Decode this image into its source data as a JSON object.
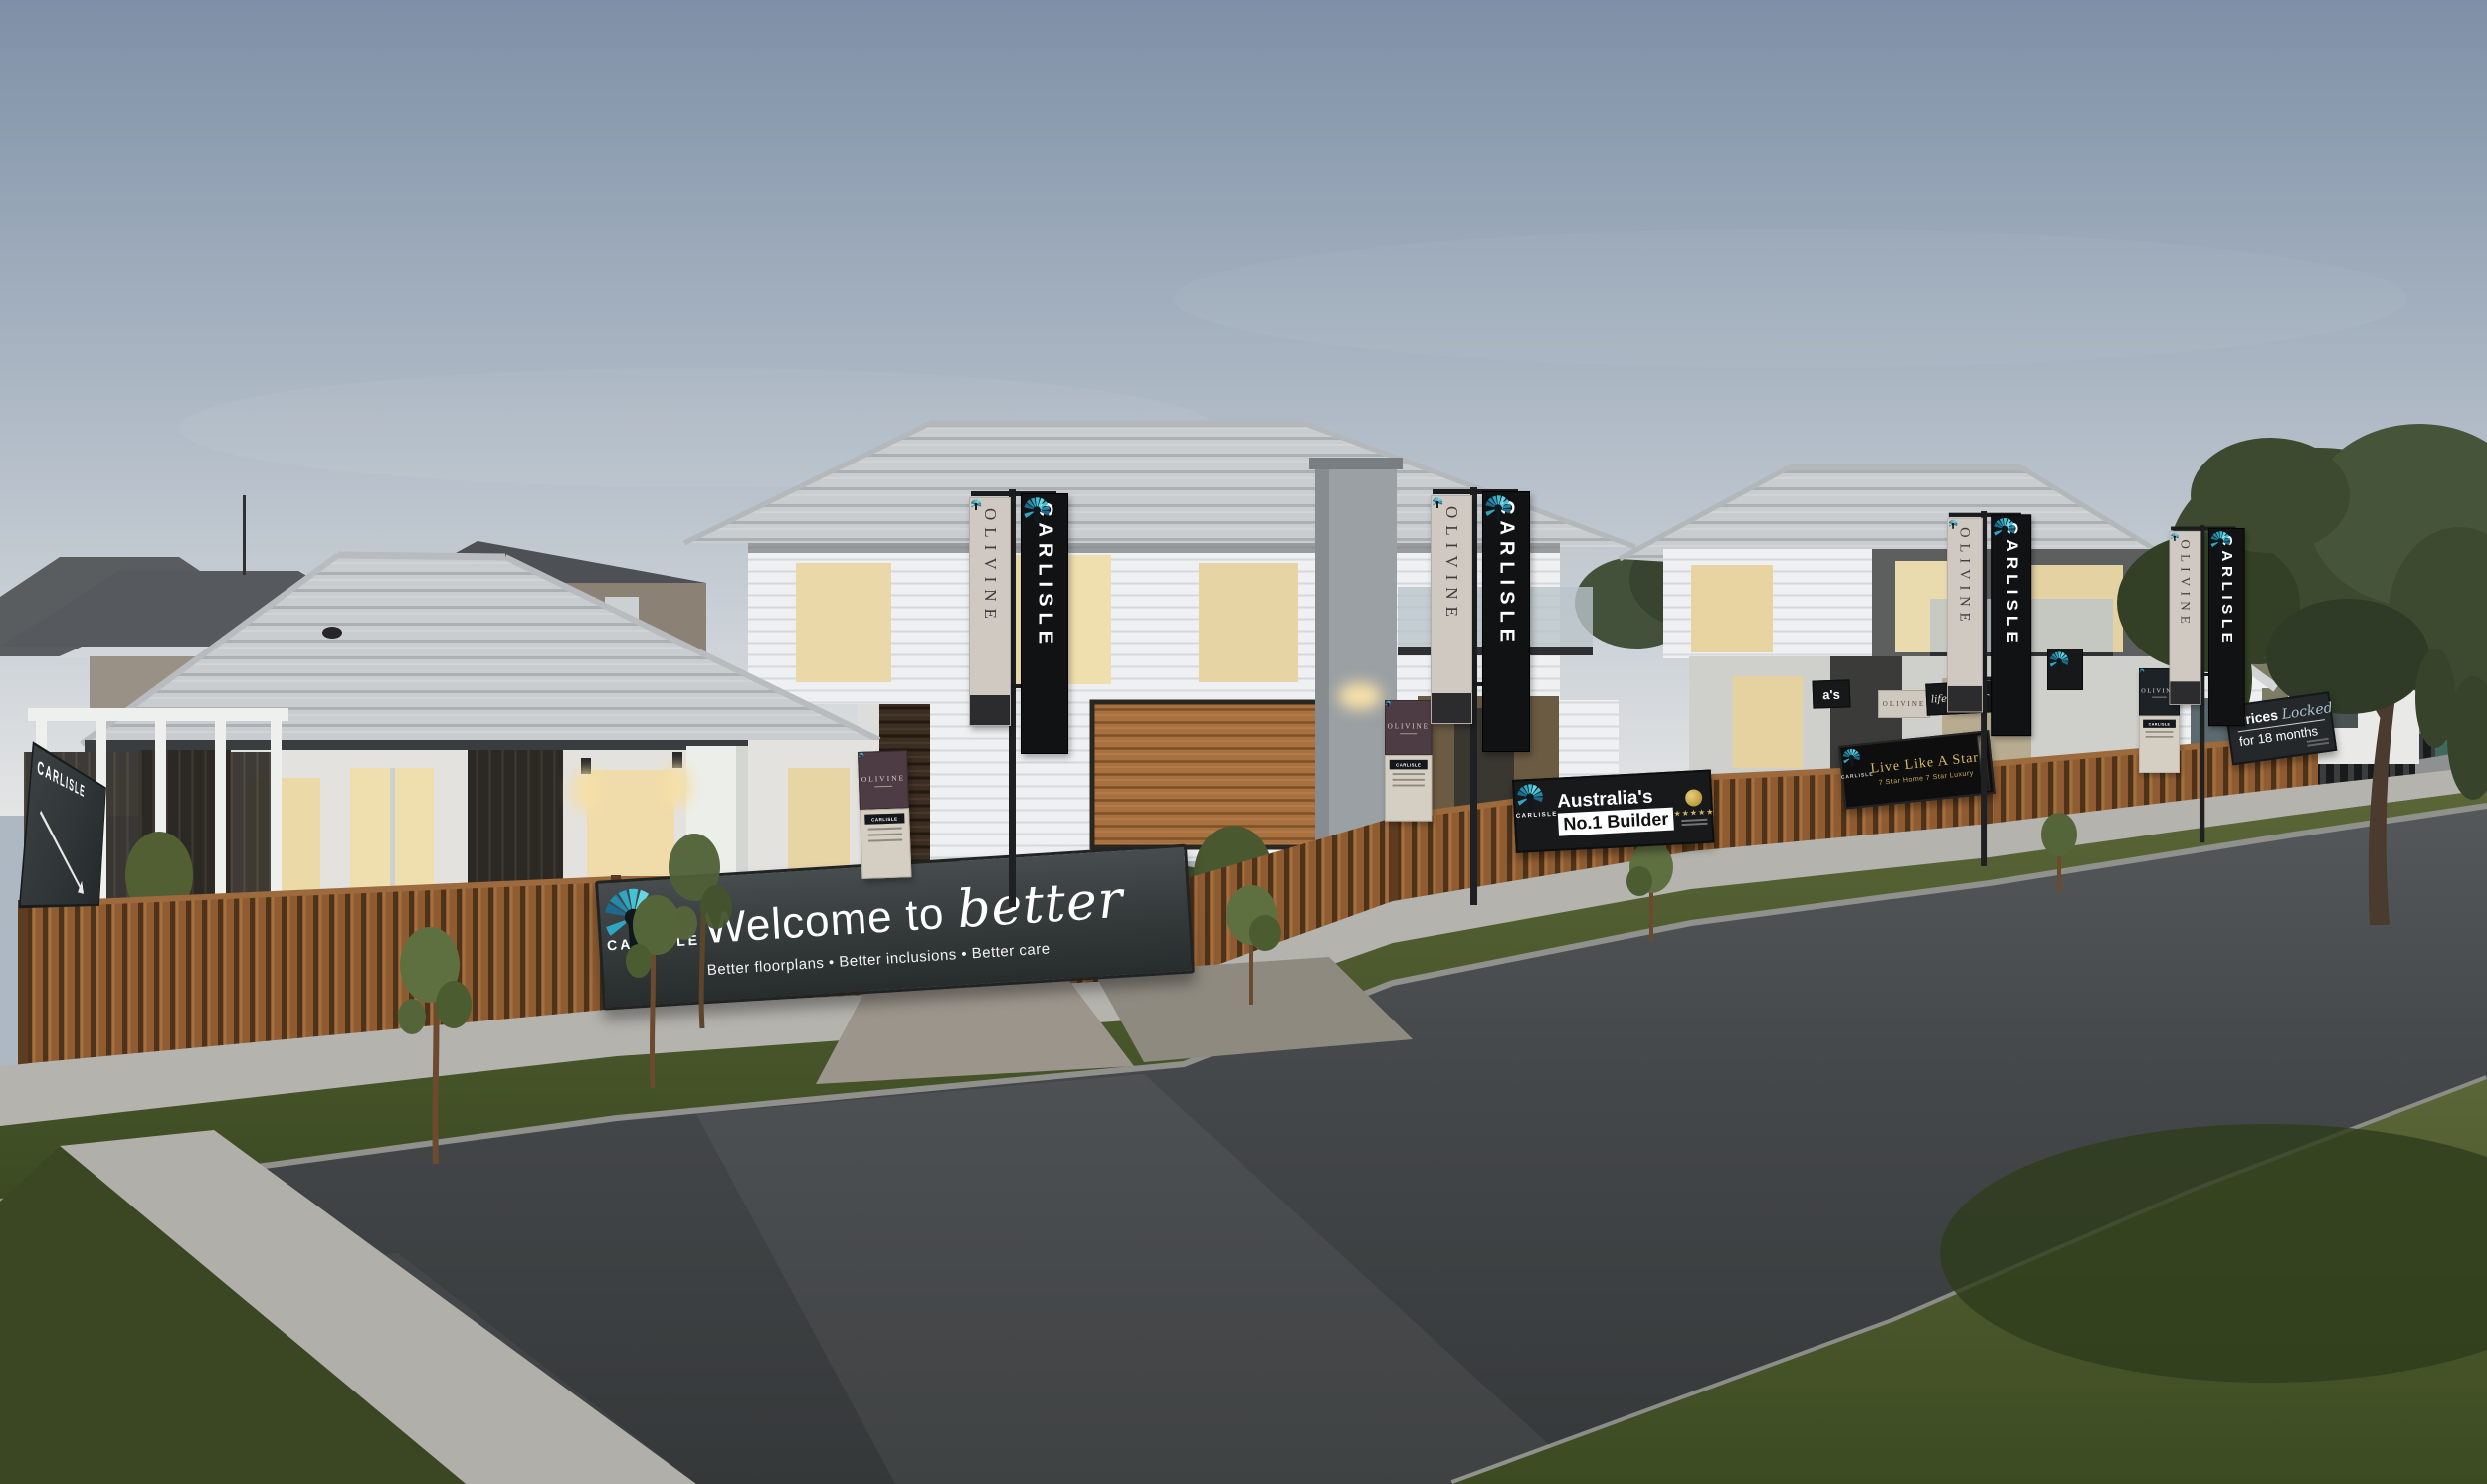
{
  "scene": {
    "description": "Carlisle Homes display village street at dusk, Olivine estate",
    "brand": "CARLISLE",
    "estate": "OLIVINE"
  },
  "colors": {
    "brand_teal": "#3fc1d4",
    "brand_dark": "#121214",
    "olivine_beige": "#d0c9c1",
    "olivine_plum": "#4e3c44",
    "sign_dark": "#343a3a",
    "gold": "#d9ba60",
    "sky_top": "#7e90a7",
    "grass": "#47572b",
    "road": "#3f4244",
    "timber_fence": "#8a5a36"
  },
  "banners": {
    "estate": "OLIVINE",
    "brand": "CARLISLE"
  },
  "signs": {
    "welcome": {
      "brand": "CARLISLE",
      "title_prefix": "Welcome to ",
      "title_script": "better",
      "subtitle": "Better floorplans  •  Better inclusions  •  Better care"
    },
    "no1": {
      "brand": "CARLISLE",
      "line1": "Australia's",
      "line2": "No.1 Builder",
      "stars": "★★★★★"
    },
    "star": {
      "brand": "CARLISLE",
      "title": "Live Like A Star",
      "subtitle": "7 Star Home 7 Star Luxury"
    },
    "prices": {
      "brand": "CARLISLE",
      "line1_regular": "Prices ",
      "line1_script": "Locked",
      "line2": "for 18 months"
    },
    "pedestal": {
      "estate": "OLIVINE",
      "brand": "CARLISLE"
    },
    "sales_hut": {
      "estate": "OLIVINE",
      "brand": "CARLISLE"
    },
    "directional": {
      "brand": "CARLISLE"
    },
    "background": {
      "partial_australias": "a's",
      "script_partial": "life's better",
      "estate": "OLIVINE"
    }
  }
}
